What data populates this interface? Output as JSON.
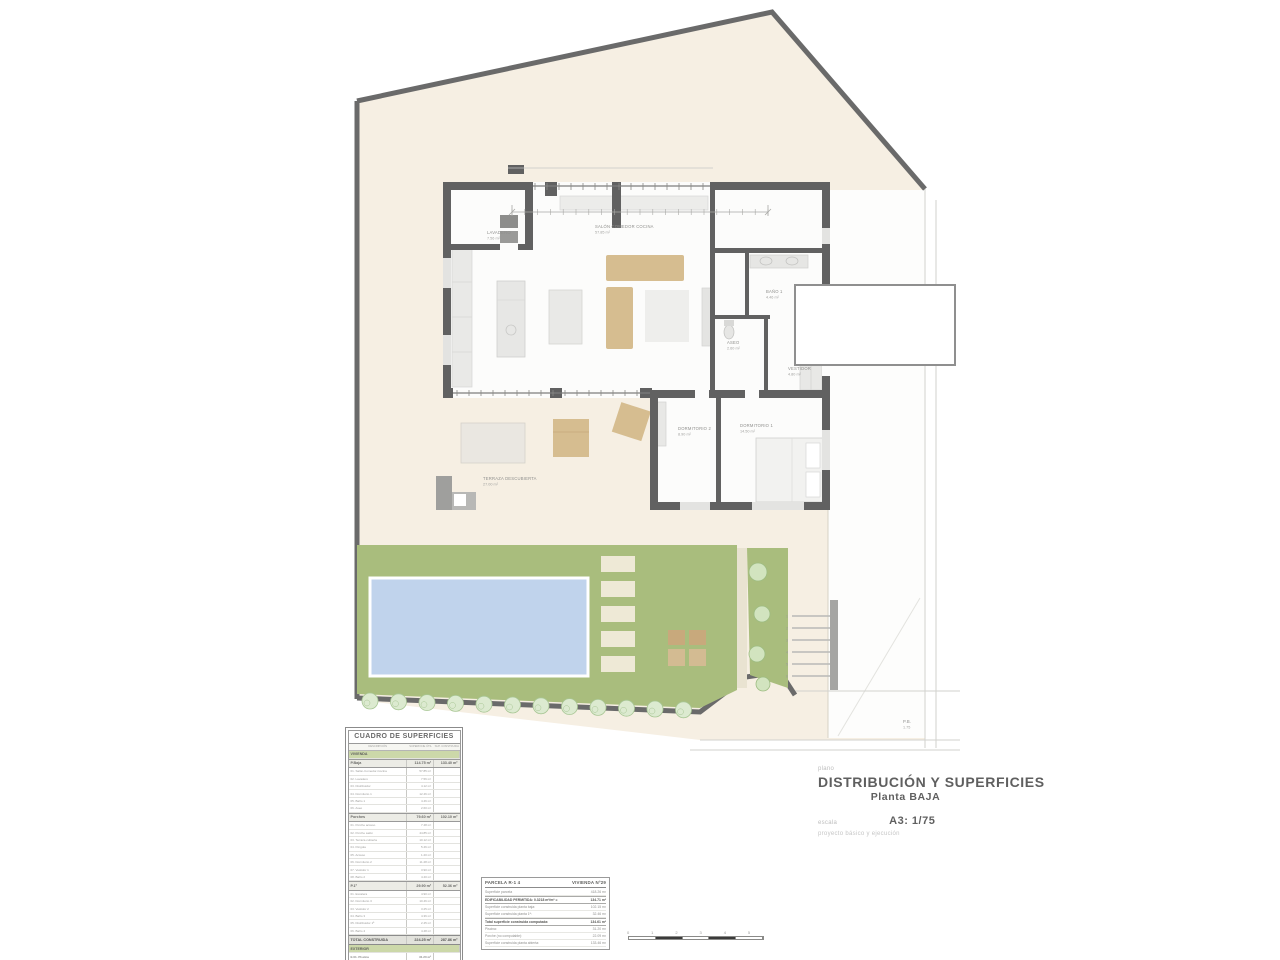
{
  "title_block": {
    "plano_label": "plano",
    "title": "DISTRIBUCIÓN Y SUPERFICIES",
    "subtitle": "Planta BAJA",
    "escala_label": "escala",
    "escala_value": "A3: 1/75",
    "project_note": "proyecto básico y ejecución"
  },
  "surfaces_table": {
    "title": "CUADRO DE SUPERFICIES",
    "columns": [
      "DESCRIPCIÓN",
      "SUPERFICIE ÚTIL",
      "SUP. CONSTRUIDA"
    ],
    "rows": [
      {
        "kind": "section",
        "name": "VIVIENDA",
        "util": "",
        "cons": ""
      },
      {
        "kind": "subtotal",
        "name": "P.Baja",
        "util": "114.75 m²",
        "cons": "133.40 m²"
      },
      {
        "kind": "item",
        "name": "01. Salón-Comedor-Cocina",
        "util": "57.85 m²",
        "cons": ""
      },
      {
        "kind": "item",
        "name": "02. Lavadero",
        "util": "7.56 m²",
        "cons": ""
      },
      {
        "kind": "item",
        "name": "03. Distribuidor",
        "util": "4.12 m²",
        "cons": ""
      },
      {
        "kind": "item",
        "name": "04. Dormitorio 1",
        "util": "12.46 m²",
        "cons": ""
      },
      {
        "kind": "item",
        "name": "05. Baño 1",
        "util": "4.46 m²",
        "cons": ""
      },
      {
        "kind": "item",
        "name": "06. Aseo",
        "util": "2.60 m²",
        "cons": ""
      },
      {
        "kind": "subtotal",
        "name": "Porches",
        "util": "79.60 m²",
        "cons": "102.10 m²"
      },
      {
        "kind": "item",
        "name": "01. Porche acceso",
        "util": "7.48 m²",
        "cons": ""
      },
      {
        "kind": "item",
        "name": "02. Porche salón",
        "util": "44.85 m²",
        "cons": ""
      },
      {
        "kind": "item",
        "name": "03. Terraza cubierta",
        "util": "10.12 m²",
        "cons": ""
      },
      {
        "kind": "item",
        "name": "04. Pérgola",
        "util": "5.46 m²",
        "cons": ""
      },
      {
        "kind": "item",
        "name": "05. Acceso",
        "util": "1.20 m²",
        "cons": ""
      },
      {
        "kind": "item",
        "name": "06. Dormitorio 2",
        "util": "11.28 m²",
        "cons": ""
      },
      {
        "kind": "item",
        "name": "07. Vestidor 1",
        "util": "3.90 m²",
        "cons": ""
      },
      {
        "kind": "item",
        "name": "08. Baño 2",
        "util": "4.40 m²",
        "cons": ""
      },
      {
        "kind": "subtotal",
        "name": "P.1ª",
        "util": "29.90 m²",
        "cons": "52.36 m²"
      },
      {
        "kind": "item",
        "name": "01. Escalera",
        "util": "4.90 m²",
        "cons": ""
      },
      {
        "kind": "item",
        "name": "02. Dormitorio 3",
        "util": "10.46 m²",
        "cons": ""
      },
      {
        "kind": "item",
        "name": "03. Vestidor 2",
        "util": "3.25 m²",
        "cons": ""
      },
      {
        "kind": "item",
        "name": "04. Baño 3",
        "util": "4.36 m²",
        "cons": ""
      },
      {
        "kind": "item",
        "name": "05. Distribuidor 1ª",
        "util": "2.45 m²",
        "cons": ""
      },
      {
        "kind": "item",
        "name": "06. Baño 4",
        "util": "4.48 m²",
        "cons": ""
      },
      {
        "kind": "total",
        "name": "TOTAL CONSTRUIDA",
        "util": "224.25 m²",
        "cons": "287.86 m²"
      },
      {
        "kind": "section",
        "name": "EXTERIOR",
        "util": "",
        "cons": ""
      },
      {
        "kind": "item2",
        "name": "E.01. Piscina",
        "util": "31.20 m²",
        "cons": ""
      },
      {
        "kind": "item2",
        "name": "E.02. Terraza descubierta (no computable)",
        "util": "27.00 m²",
        "cons": ""
      },
      {
        "kind": "item2",
        "name": "E.03. Jardín (no computable)",
        "util": "180.46 m²",
        "cons": ""
      }
    ]
  },
  "info_box": {
    "header_left": "PARCELA R-1 4",
    "header_right": "VIVIENDA Nº29",
    "rows": [
      {
        "label": "Superficie parcela",
        "value": "418.26 m²",
        "bold": false
      },
      {
        "label": "EDIFICABILIDAD PERMITIDA: 0.3218 m²/m² =",
        "value": "134.71 m²",
        "bold": true
      },
      {
        "label": "Superficie construida planta baja:",
        "value": "102.15 m²",
        "bold": false
      },
      {
        "label": "Superficie construida planta 1ª:",
        "value": "32.46 m²",
        "bold": false
      },
      {
        "label": "Total superficie construida computada:",
        "value": "134.61 m²",
        "bold": true
      },
      {
        "label": "Piscina:",
        "value": "31.20 m²",
        "bold": false
      },
      {
        "label": "Porche (no computable):",
        "value": "22.09 m²",
        "bold": false
      },
      {
        "label": "Superficie construida planta abierta:",
        "value": "133.46 m²",
        "bold": false
      }
    ]
  },
  "plan": {
    "labels": [
      {
        "name": "LAVADERO",
        "area": "7.56 m²",
        "x": 487,
        "y": 234
      },
      {
        "name": "SALÓN COMEDOR COCINA",
        "area": "57.85 m²",
        "x": 595,
        "y": 228
      },
      {
        "name": "BAÑO 1",
        "area": "4.46 m²",
        "x": 766,
        "y": 293
      },
      {
        "name": "ASEO",
        "area": "2.60 m²",
        "x": 727,
        "y": 344
      },
      {
        "name": "VESTIDOR",
        "area": "4.80 m²",
        "x": 788,
        "y": 370
      },
      {
        "name": "DORMITORIO 2",
        "area": "8.90 m²",
        "x": 678,
        "y": 430
      },
      {
        "name": "DORMITORIO 1",
        "area": "14.50 m²",
        "x": 740,
        "y": 427
      },
      {
        "name": "TERRAZA DESCUBIERTA",
        "area": "27.00 m²",
        "x": 483,
        "y": 480
      },
      {
        "name": "P.B.",
        "area": "1.75",
        "x": 903,
        "y": 723
      }
    ],
    "stair_numbers": [
      "1",
      "2",
      "3",
      "4",
      "5",
      "6"
    ],
    "colors": {
      "parcel": "#f6efe3",
      "garden": "#a9bd7d",
      "garden_dark": "#9cb974",
      "pool": "#c0d3ec",
      "wall": "#616161",
      "stone": "#eee9d6",
      "wood": "#d6bd90",
      "hedge": "#dcead0",
      "hedge_line": "#a8c694"
    }
  },
  "scale_bar": {
    "ticks": [
      "0",
      "1",
      "2",
      "3",
      "4",
      "5"
    ]
  }
}
